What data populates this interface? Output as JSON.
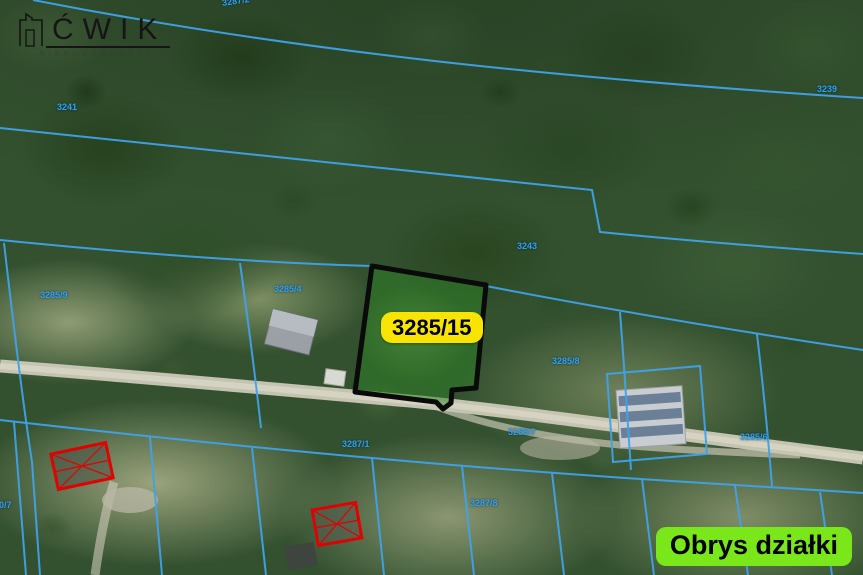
{
  "brand": {
    "logo_text": "ĆWIK",
    "logo_subtitle": "NIERUCHOMOŚCI",
    "logo_icon": "building-outline-icon"
  },
  "highlighted_parcel": {
    "label": "3285/15",
    "label_bg": "#f8e400",
    "fill_color": "#2e8426",
    "outline_color": "#000000"
  },
  "legend_badge": {
    "text": "Obrys działki",
    "bg": "#79e719",
    "text_color": "#000000"
  },
  "map": {
    "boundary_line_color": "#3fa3ea",
    "building_marker_color": "#e00000",
    "parcel_labels": [
      {
        "text": "3287/2"
      },
      {
        "text": "3241"
      },
      {
        "text": "3239"
      },
      {
        "text": "3243"
      },
      {
        "text": "3285/9"
      },
      {
        "text": "3285/4"
      },
      {
        "text": "3285/8"
      },
      {
        "text": "3287/1"
      },
      {
        "text": "3285/7"
      },
      {
        "text": "3285/6"
      },
      {
        "text": "3290/7"
      },
      {
        "text": "3287/8"
      }
    ]
  }
}
